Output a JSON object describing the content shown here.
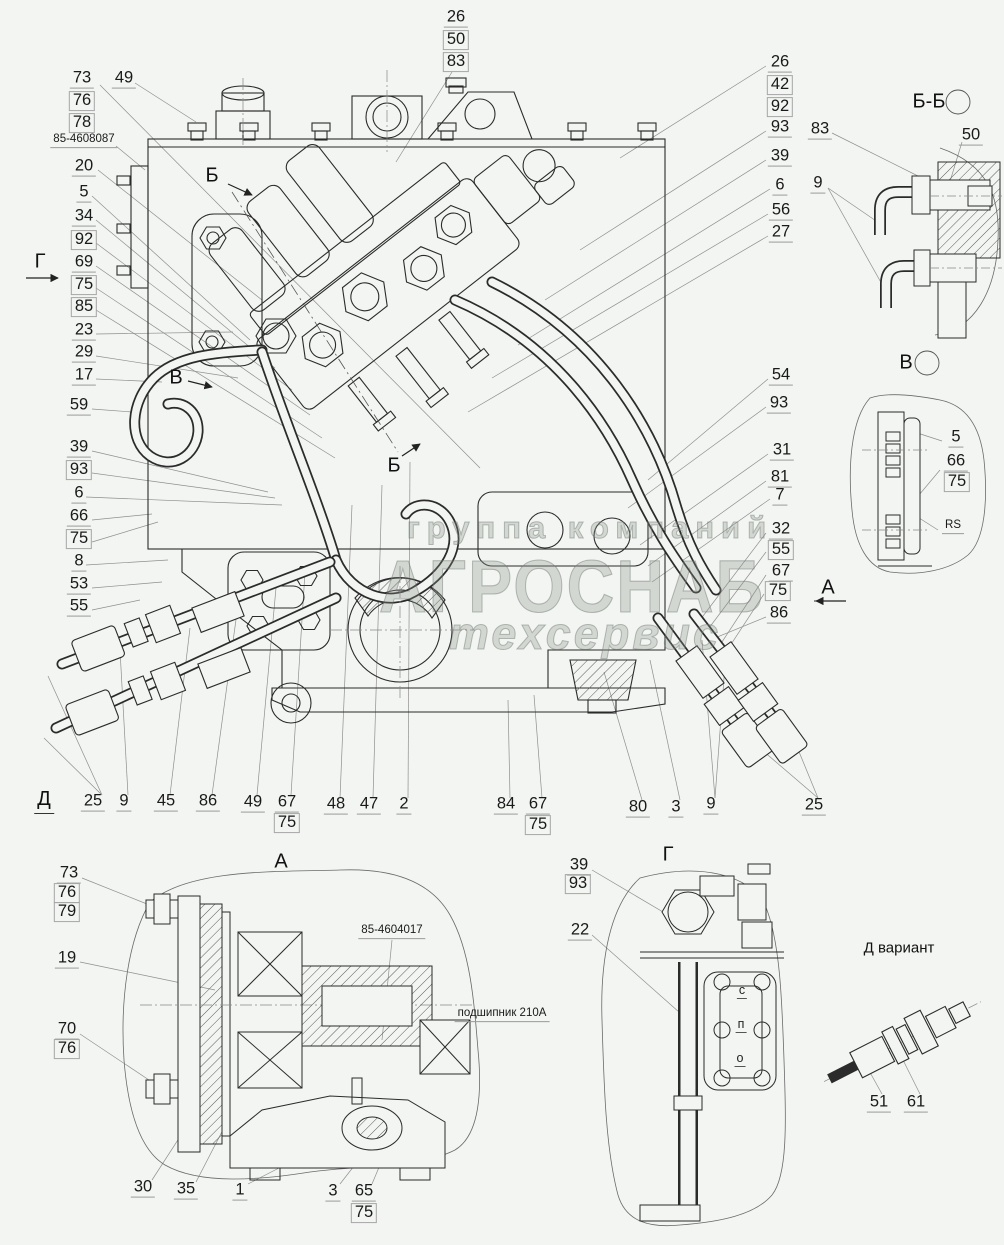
{
  "meta": {
    "background": "#f2f5f1",
    "ink": "#2b2b2b",
    "leader_color": "#8f8f8f",
    "watermark_color": "#8c928c"
  },
  "watermark": {
    "line1": "группа компаний",
    "line2": "АГРОСНАБ",
    "line3": "техсервис"
  },
  "callouts": [
    {
      "t": "73",
      "x": 82,
      "y": 79
    },
    {
      "t": "76",
      "x": 82,
      "y": 101,
      "boxed": true
    },
    {
      "t": "78",
      "x": 82,
      "y": 123,
      "boxed": true
    },
    {
      "t": "49",
      "x": 124,
      "y": 79
    },
    {
      "t": "85-4608087",
      "x": 84,
      "y": 141,
      "small": true
    },
    {
      "t": "20",
      "x": 84,
      "y": 167
    },
    {
      "t": "5",
      "x": 84,
      "y": 193
    },
    {
      "t": "34",
      "x": 84,
      "y": 217
    },
    {
      "t": "92",
      "x": 84,
      "y": 240,
      "boxed": true
    },
    {
      "t": "69",
      "x": 84,
      "y": 263
    },
    {
      "t": "75",
      "x": 84,
      "y": 285,
      "boxed": true
    },
    {
      "t": "85",
      "x": 84,
      "y": 307,
      "boxed": true
    },
    {
      "t": "23",
      "x": 84,
      "y": 331
    },
    {
      "t": "29",
      "x": 84,
      "y": 353
    },
    {
      "t": "17",
      "x": 84,
      "y": 376
    },
    {
      "t": "59",
      "x": 79,
      "y": 406
    },
    {
      "t": "39",
      "x": 79,
      "y": 448
    },
    {
      "t": "93",
      "x": 79,
      "y": 470,
      "boxed": true
    },
    {
      "t": "6",
      "x": 79,
      "y": 494
    },
    {
      "t": "66",
      "x": 79,
      "y": 517
    },
    {
      "t": "75",
      "x": 79,
      "y": 539,
      "boxed": true
    },
    {
      "t": "8",
      "x": 79,
      "y": 562
    },
    {
      "t": "53",
      "x": 79,
      "y": 585
    },
    {
      "t": "55",
      "x": 79,
      "y": 607
    },
    {
      "t": "26",
      "x": 456,
      "y": 18
    },
    {
      "t": "50",
      "x": 456,
      "y": 40,
      "boxed": true
    },
    {
      "t": "83",
      "x": 456,
      "y": 62,
      "boxed": true
    },
    {
      "t": "26",
      "x": 780,
      "y": 63
    },
    {
      "t": "42",
      "x": 780,
      "y": 85,
      "boxed": true
    },
    {
      "t": "92",
      "x": 780,
      "y": 107,
      "boxed": true
    },
    {
      "t": "93",
      "x": 780,
      "y": 128
    },
    {
      "t": "39",
      "x": 780,
      "y": 157
    },
    {
      "t": "6",
      "x": 780,
      "y": 186
    },
    {
      "t": "56",
      "x": 781,
      "y": 211
    },
    {
      "t": "27",
      "x": 781,
      "y": 233
    },
    {
      "t": "83",
      "x": 820,
      "y": 130
    },
    {
      "t": "50",
      "x": 971,
      "y": 136
    },
    {
      "t": "9",
      "x": 818,
      "y": 184
    },
    {
      "t": "54",
      "x": 781,
      "y": 376
    },
    {
      "t": "93",
      "x": 779,
      "y": 404
    },
    {
      "t": "31",
      "x": 782,
      "y": 451
    },
    {
      "t": "81",
      "x": 780,
      "y": 478
    },
    {
      "t": "7",
      "x": 780,
      "y": 496
    },
    {
      "t": "32",
      "x": 781,
      "y": 530
    },
    {
      "t": "55",
      "x": 781,
      "y": 550,
      "boxed": true
    },
    {
      "t": "67",
      "x": 781,
      "y": 572
    },
    {
      "t": "75",
      "x": 778,
      "y": 591,
      "boxed": true
    },
    {
      "t": "86",
      "x": 779,
      "y": 614
    },
    {
      "t": "5",
      "x": 956,
      "y": 438
    },
    {
      "t": "66",
      "x": 956,
      "y": 462
    },
    {
      "t": "75",
      "x": 957,
      "y": 482,
      "boxed": true
    },
    {
      "t": "RS",
      "x": 953,
      "y": 527,
      "small": true
    },
    {
      "t": "25",
      "x": 93,
      "y": 802
    },
    {
      "t": "9",
      "x": 124,
      "y": 802
    },
    {
      "t": "45",
      "x": 166,
      "y": 802
    },
    {
      "t": "86",
      "x": 208,
      "y": 802
    },
    {
      "t": "49",
      "x": 253,
      "y": 803
    },
    {
      "t": "67",
      "x": 287,
      "y": 803
    },
    {
      "t": "75",
      "x": 287,
      "y": 823,
      "boxed": true
    },
    {
      "t": "48",
      "x": 336,
      "y": 805
    },
    {
      "t": "47",
      "x": 369,
      "y": 805
    },
    {
      "t": "2",
      "x": 404,
      "y": 805
    },
    {
      "t": "84",
      "x": 506,
      "y": 805
    },
    {
      "t": "67",
      "x": 538,
      "y": 805
    },
    {
      "t": "75",
      "x": 538,
      "y": 825,
      "boxed": true
    },
    {
      "t": "80",
      "x": 638,
      "y": 808
    },
    {
      "t": "3",
      "x": 676,
      "y": 808
    },
    {
      "t": "9",
      "x": 711,
      "y": 805
    },
    {
      "t": "25",
      "x": 814,
      "y": 806
    },
    {
      "t": "73",
      "x": 69,
      "y": 874
    },
    {
      "t": "76",
      "x": 67,
      "y": 893,
      "boxed": true
    },
    {
      "t": "79",
      "x": 67,
      "y": 912,
      "boxed": true
    },
    {
      "t": "19",
      "x": 67,
      "y": 959
    },
    {
      "t": "70",
      "x": 67,
      "y": 1030
    },
    {
      "t": "76",
      "x": 67,
      "y": 1049,
      "boxed": true
    },
    {
      "t": "85-4604017",
      "x": 392,
      "y": 932,
      "small": true
    },
    {
      "t": "подшипник 210А",
      "x": 502,
      "y": 1015,
      "small": true
    },
    {
      "t": "30",
      "x": 143,
      "y": 1188
    },
    {
      "t": "35",
      "x": 186,
      "y": 1190
    },
    {
      "t": "1",
      "x": 240,
      "y": 1191
    },
    {
      "t": "3",
      "x": 333,
      "y": 1192
    },
    {
      "t": "65",
      "x": 364,
      "y": 1192
    },
    {
      "t": "75",
      "x": 364,
      "y": 1213,
      "boxed": true
    },
    {
      "t": "39",
      "x": 579,
      "y": 866
    },
    {
      "t": "93",
      "x": 578,
      "y": 884,
      "boxed": true
    },
    {
      "t": "22",
      "x": 580,
      "y": 931
    },
    {
      "t": "51",
      "x": 879,
      "y": 1103
    },
    {
      "t": "61",
      "x": 916,
      "y": 1103
    }
  ],
  "views": [
    {
      "t": "Г",
      "x": 40,
      "y": 262
    },
    {
      "t": "Б",
      "x": 212,
      "y": 176
    },
    {
      "t": "В",
      "x": 176,
      "y": 378
    },
    {
      "t": "Б",
      "x": 394,
      "y": 466
    },
    {
      "t": "Б-Б",
      "x": 929,
      "y": 102
    },
    {
      "t": "В",
      "x": 906,
      "y": 363
    },
    {
      "t": "А",
      "x": 828,
      "y": 588
    },
    {
      "t": "А",
      "x": 281,
      "y": 862
    },
    {
      "t": "Г",
      "x": 668,
      "y": 855
    },
    {
      "t": "Д",
      "x": 44,
      "y": 801,
      "cls": "u"
    },
    {
      "t": "Д вариант",
      "x": 899,
      "y": 948,
      "cls": "sub"
    }
  ],
  "sight": [
    {
      "t": "с",
      "x": 742,
      "y": 991
    },
    {
      "t": "п",
      "x": 741,
      "y": 1025
    },
    {
      "t": "о",
      "x": 740,
      "y": 1059
    }
  ]
}
